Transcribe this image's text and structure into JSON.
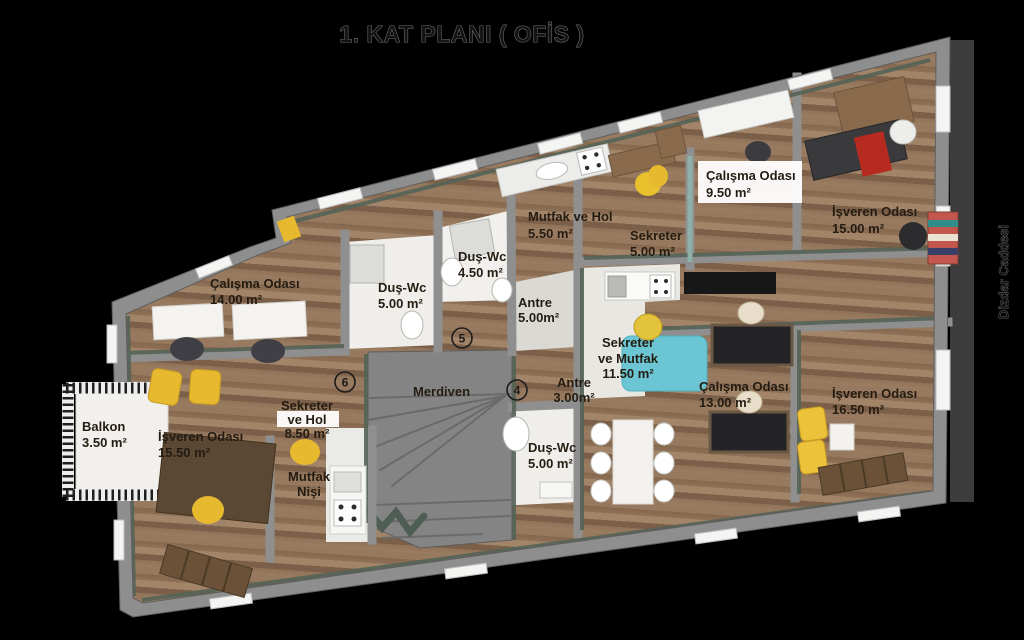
{
  "title": "1. KAT PLANI ( OFİS )",
  "street": "Dizdar Caddesi",
  "rooms": [
    {
      "name": "Çalışma Odası",
      "area": "9.50 m²"
    },
    {
      "name": "İşveren Odası",
      "area": "15.00 m²"
    },
    {
      "name": "Mutfak ve Hol",
      "area": "5.50 m²"
    },
    {
      "name": "Sekreter",
      "area": "5.00 m²"
    },
    {
      "name": "Duş-Wc",
      "area": "4.50 m²"
    },
    {
      "name": "Duş-Wc",
      "area": "5.00 m²"
    },
    {
      "name": "Çalışma Odası",
      "area": "14.00 m²"
    },
    {
      "name": "Antre",
      "area": "5.00m²"
    },
    {
      "name": "Sekreter",
      "name2": "ve Mutfak",
      "area": "11.50 m²"
    },
    {
      "name": "Merdiven",
      "area": ""
    },
    {
      "name": "Antre",
      "area": "3.00m²"
    },
    {
      "name": "Çalışma Odası",
      "area": "13.00 m²"
    },
    {
      "name": "İşveren Odası",
      "area": "16.50 m²"
    },
    {
      "name": "Balkon",
      "area": "3.50 m²"
    },
    {
      "name": "İşveren Odası",
      "area": "15.50 m²"
    },
    {
      "name": "Sekreter",
      "name2": "ve Hol",
      "area": "8.50 m²"
    },
    {
      "name": "Mutfak",
      "name2": "Nişi",
      "area": ""
    },
    {
      "name": "Duş-Wc",
      "area": "5.00 m²"
    }
  ],
  "markers": {
    "m4": "4",
    "m5": "5",
    "m6": "6"
  },
  "colors": {
    "background": "#000000",
    "wall": "#8e8e8e",
    "wall_accent": "#556357",
    "floor_wood": "#8f7158",
    "wet_floor": "#efeeea",
    "furniture_yellow": "#e6b92e",
    "furniture_cyan": "#6cc5d2",
    "furniture_red": "#b62a20",
    "label_text": "#241c12"
  }
}
